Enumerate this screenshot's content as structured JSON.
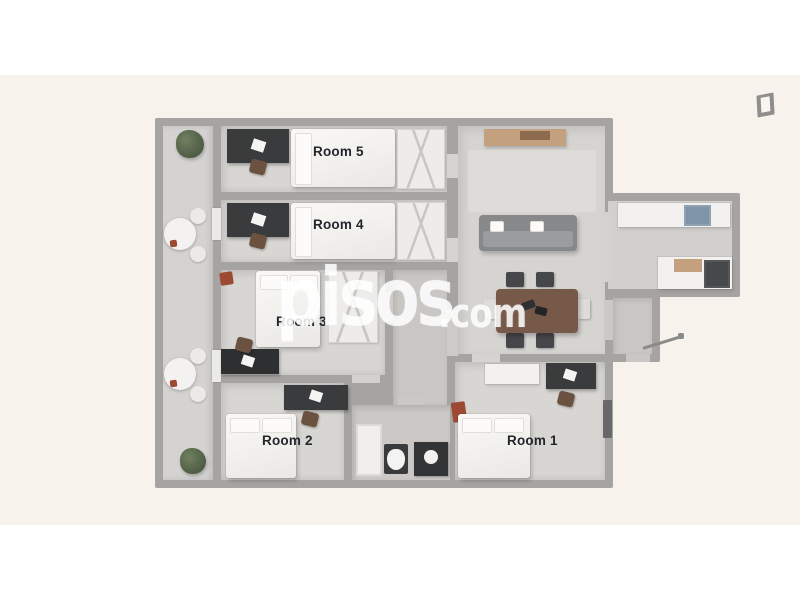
{
  "photo": {
    "background_color": "#f7f2ec",
    "wall_color": "#a5a4a2",
    "description": "3D top-down floor plan of a 5-bedroom apartment with balcony, living-dining room, kitchen and bathroom"
  },
  "watermark": {
    "brand": "pisos",
    "tld": ".com",
    "color": "#ffffff"
  },
  "rooms": [
    {
      "id": "room-1",
      "label": "Room 1"
    },
    {
      "id": "room-2",
      "label": "Room 2"
    },
    {
      "id": "room-3",
      "label": "Room 3"
    },
    {
      "id": "room-4",
      "label": "Room 4"
    },
    {
      "id": "room-5",
      "label": "Room 5"
    }
  ],
  "icons": {
    "top_right": "open-door-icon"
  }
}
